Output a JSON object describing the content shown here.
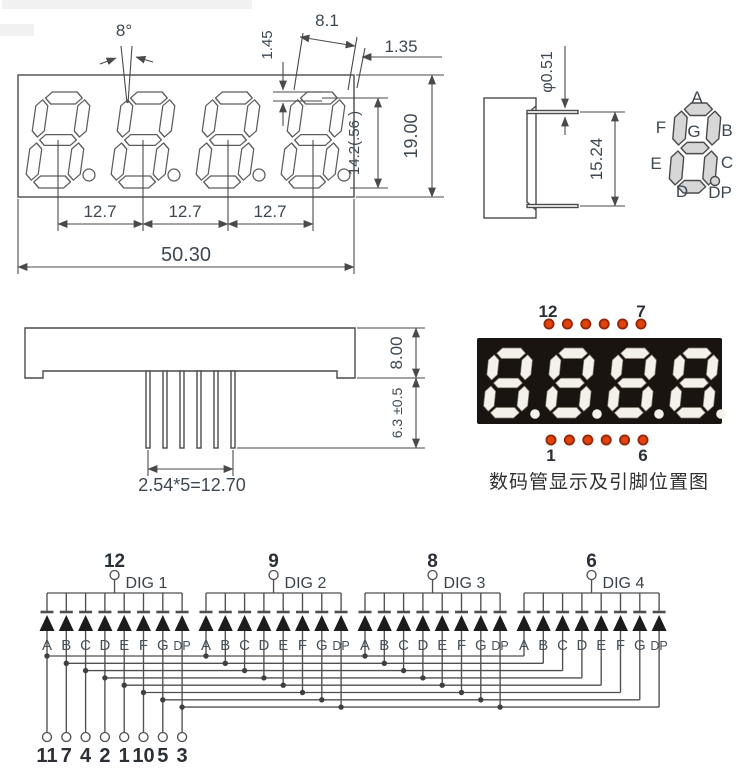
{
  "front_view": {
    "angle_label": "8°",
    "digit_width": "8.1",
    "segment_thickness": "1.45",
    "edge_gap": "1.35",
    "package_height": "19.00",
    "digit_height": "14.2(.56 )",
    "digit_pitch_1": "12.7",
    "digit_pitch_2": "12.7",
    "digit_pitch_3": "12.7",
    "package_width": "50.30"
  },
  "side_view": {
    "pin_diameter": "φ0.51",
    "pin_row_spacing": "15.24"
  },
  "segment_diagram": {
    "a": "A",
    "b": "B",
    "c": "C",
    "d": "D",
    "e": "E",
    "f": "F",
    "g": "G",
    "dp": "DP"
  },
  "bottom_view": {
    "body_thickness": "8.00",
    "pin_length": "6.3 ±0.5",
    "pin_pitch": "2.54*5=12.70"
  },
  "pin_position": {
    "top_left_pin": "12",
    "top_right_pin": "7",
    "bottom_left_pin": "1",
    "bottom_right_pin": "6",
    "caption": "数码管显示及引脚位置图"
  },
  "schematic": {
    "digit_groups": [
      {
        "pin": "12",
        "label": "DIG 1"
      },
      {
        "pin": "9",
        "label": "DIG 2"
      },
      {
        "pin": "8",
        "label": "DIG 3"
      },
      {
        "pin": "6",
        "label": "DIG 4"
      }
    ],
    "segment_labels": [
      "A",
      "B",
      "C",
      "D",
      "E",
      "F",
      "G",
      "DP"
    ],
    "bottom_pins": [
      "11",
      "7",
      "4",
      "2",
      "1",
      "10",
      "5",
      "3"
    ]
  },
  "colors": {
    "line": "#4a4a4a",
    "dim_text": "#3e4852",
    "diode": "#1c1c1c",
    "dot_fill": "#e2430e",
    "dot_stroke": "#8f2708",
    "display_bg": "#1a1410",
    "digit_on": "#f4f1ea",
    "segment_fill": "#d7d7d7",
    "caption_text": "#2f2f2f"
  }
}
